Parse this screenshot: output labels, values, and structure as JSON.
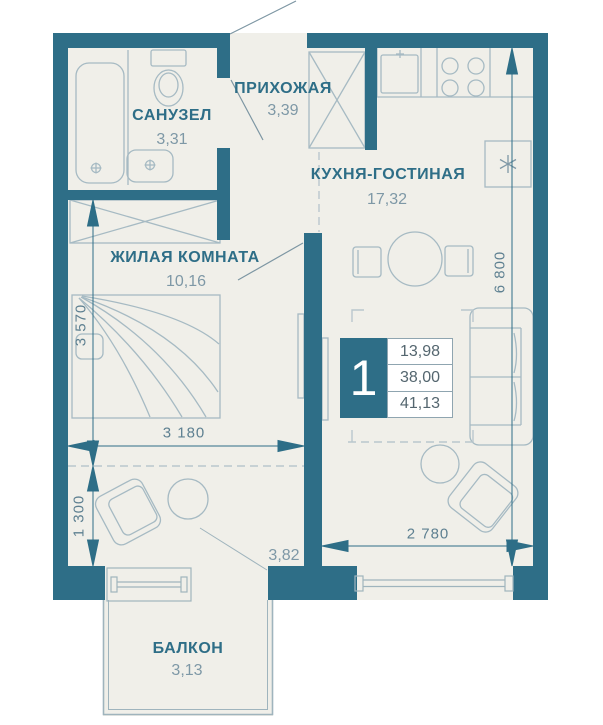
{
  "plan": {
    "unit": {
      "number": "1",
      "areas": {
        "living": "13,98",
        "floor": "38,00",
        "total": "41,13"
      }
    },
    "rooms": [
      {
        "name": "САНУЗЕЛ",
        "area": "3,31"
      },
      {
        "name": "ПРИХОЖАЯ",
        "area": "3,39"
      },
      {
        "name": "КУХНЯ-ГОСТИНАЯ",
        "area": "17,32"
      },
      {
        "name": "ЖИЛАЯ КОМНАТА",
        "area": "10,16"
      },
      {
        "name": "БАЛКОН",
        "area": "3,13"
      },
      {
        "name": "",
        "area": "3,82"
      }
    ],
    "dimensions": {
      "living_width": "3 180",
      "kitchen_width": "2 780",
      "total_height": "6 800",
      "living_height": "3 570",
      "niche_height": "1 300"
    },
    "colors": {
      "wall": "#2e6e87",
      "floor": "#f0efe9",
      "label_accent": "#2e6e87",
      "label_muted": "#7e98a6",
      "dimension_text": "#5e8091",
      "furniture_line": "#a6bac3"
    }
  }
}
